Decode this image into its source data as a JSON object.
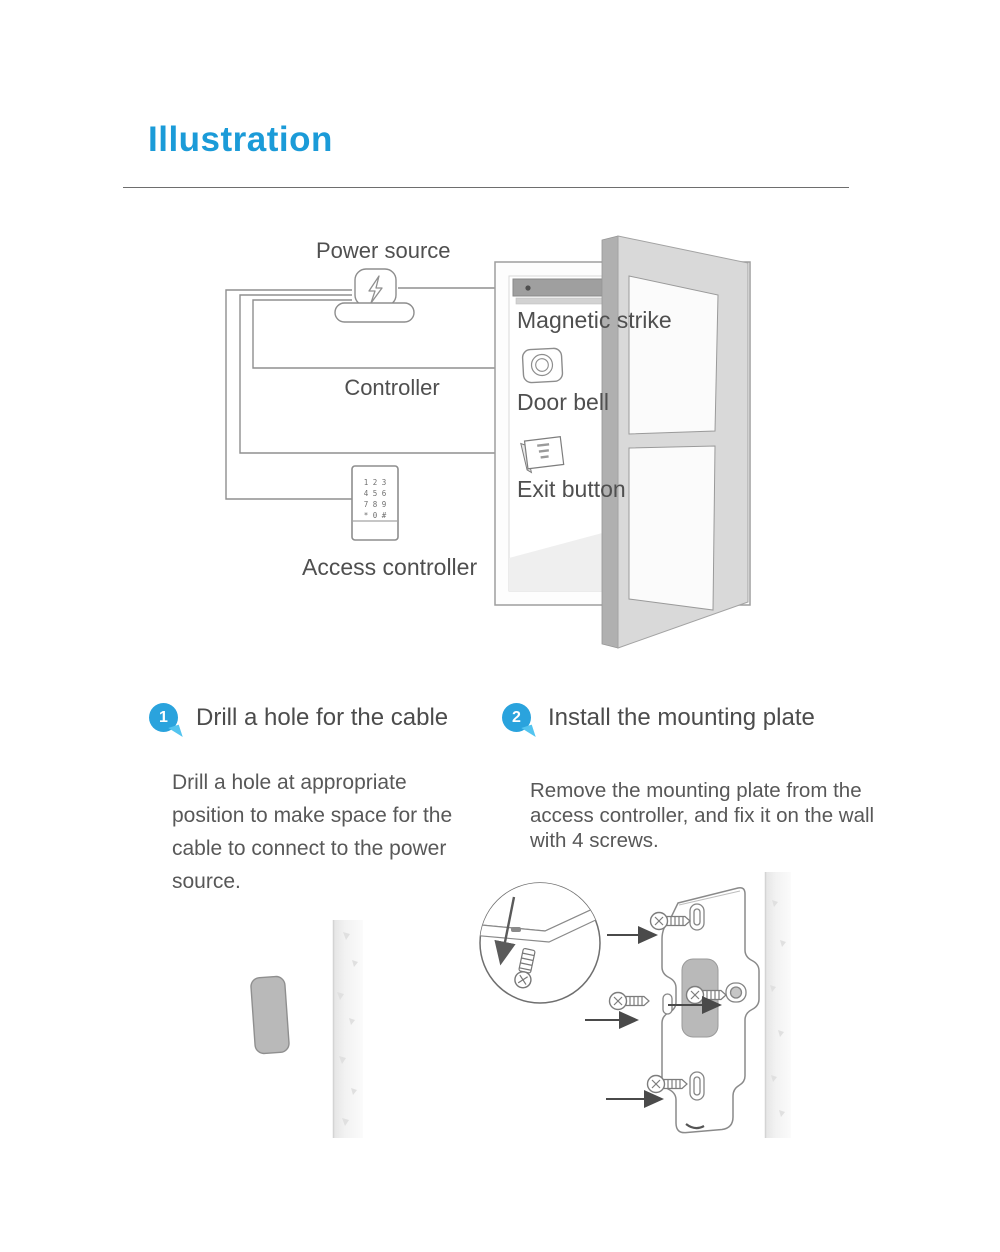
{
  "page": {
    "title": "Illustration"
  },
  "colors": {
    "accent_blue": "#1b9bd8",
    "badge_blue": "#2aa3dd",
    "badge_tail_blue": "#53c4ef",
    "heading_text": "#4c4c4c",
    "body_text": "#585858",
    "line_art_gray": "#8d8d8d",
    "door_gray": "#d9d9d9",
    "hinge_gray": "#b0b0b0",
    "hole_gray": "#b9b9b9"
  },
  "icons": {
    "power_source_icon": "lightning-bolt plug",
    "door_bell_icon": "concentric-circles button",
    "exit_button_icon": "small wall panel",
    "access_controller_icon": "numeric keypad",
    "magnifier_icon": "zoom detail circle",
    "screw_icon": "phillips screw",
    "arrow_icon": "solid right arrow",
    "step_badge_icon": "numbered speech bubble"
  },
  "diagram": {
    "labels": {
      "power_source": "Power source",
      "controller": "Controller",
      "magnetic_strike": "Magnetic strike",
      "door_bell": "Door bell",
      "exit_button": "Exit button",
      "access_controller": "Access controller"
    },
    "keypad_rows": [
      "1 2 3",
      "4 5 6",
      "7 8 9",
      "* 0 #"
    ]
  },
  "steps": [
    {
      "number": "1",
      "title": "Drill a hole for the cable",
      "body": "Drill a hole at appropriate position to make space for the cable to connect to the power source."
    },
    {
      "number": "2",
      "title": "Install the mounting plate",
      "body": "Remove the mounting plate from the access controller, and fix it on the wall with 4 screws."
    }
  ]
}
